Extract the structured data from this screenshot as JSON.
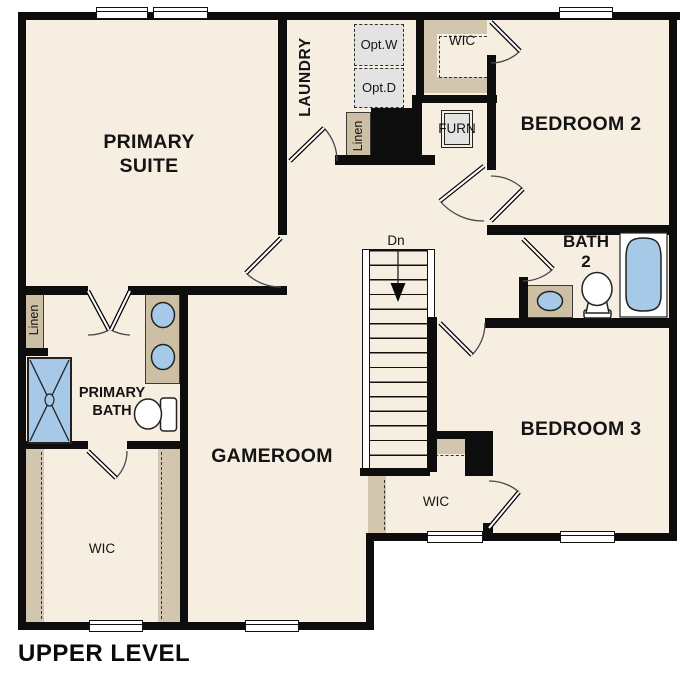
{
  "title": {
    "text": "UPPER LEVEL"
  },
  "colors": {
    "wall": "#0d0d0d",
    "floor": "#f6eee1",
    "counter_tan": "#cdbfa4",
    "closet_tan": "#d2c6af",
    "fixture_blue": "#a7c9e8",
    "appliance_gray": "#e3e3e3"
  },
  "rooms": {
    "primary_suite": {
      "line1": "PRIMARY",
      "line2": "SUITE"
    },
    "laundry": {
      "label": "LAUNDRY"
    },
    "bedroom_2": {
      "label": "BEDROOM 2"
    },
    "bedroom_3": {
      "label": "BEDROOM 3"
    },
    "gameroom": {
      "label": "GAMEROOM"
    },
    "bath_2": {
      "line1": "BATH",
      "line2": "2"
    },
    "primary_bath": {
      "line1": "PRIMARY",
      "line2": "BATH"
    },
    "wic_bedroom_2": {
      "label": "WIC"
    },
    "wic_primary": {
      "label": "WIC"
    },
    "wic_bedroom_3": {
      "label": "WIC"
    }
  },
  "features": {
    "linen_hall": {
      "label": "Linen"
    },
    "linen_primary_bath": {
      "label": "Linen"
    },
    "furnace": {
      "label": "FURN"
    },
    "optional_washer": {
      "line1": "Opt.",
      "line2": "W"
    },
    "optional_dryer": {
      "line1": "Opt.",
      "line2": "D"
    },
    "stairs": {
      "label": "Dn"
    }
  }
}
